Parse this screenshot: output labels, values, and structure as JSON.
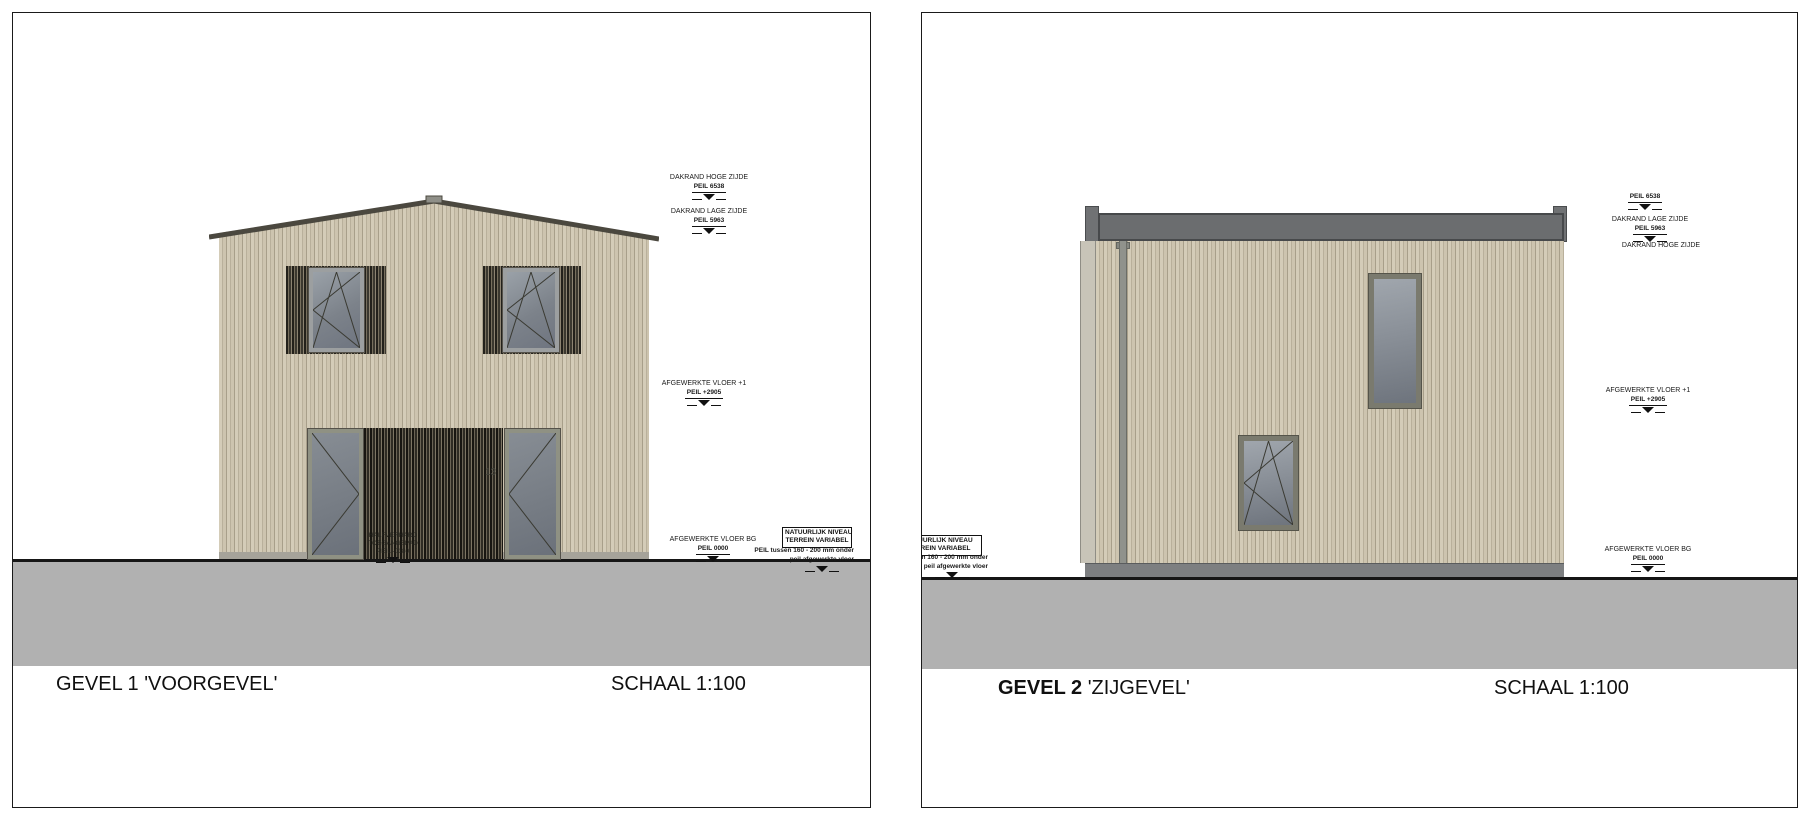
{
  "colors": {
    "facade_light": "#d4ccb8",
    "facade_stripe": "#a89f8a",
    "slats_dark": "#2e2b23",
    "window_frame": "#9c9fa0",
    "right_window_frame": "#7a7a6e",
    "glass": "#7c828a",
    "door_frame": "#8f9183",
    "roof_band": "#6b6d6f",
    "ground_band": "#b1b1b1",
    "line": "#161616"
  },
  "left_panel": {
    "title_prefix": "GEVEL 1",
    "title_name": "'VOORGEVEL'",
    "scale_label": "SCHAAL 1:100",
    "house_number": "13",
    "annotations": {
      "dakrand_hoge_label": "DAKRAND HOGE ZIJDE",
      "dakrand_hoge_peil": "PEIL 6538",
      "dakrand_lage_label": "DAKRAND LAGE ZIJDE",
      "dakrand_lage_peil": "PEIL 5963",
      "vloer1_label": "AFGEWERKTE VLOER +1",
      "vloer1_peil": "PEIL +2905",
      "vloerbg_label": "AFGEWERKTE VLOER BG",
      "vloerbg_peil": "PEIL 0000",
      "terrein_box_line1": "NATUURLIJK NIVEAU",
      "terrein_box_line2": "TERREIN VARIABEL",
      "terrein_note_line1": "PEIL tussen 160 - 200 mm onder",
      "terrein_note_line2": "peil afgewerkte vloer",
      "toegangspad_line1": "HALFVERHARD",
      "toegangspad_line2": "TOEGANGSPAD",
      "toegangspad_line3": "PEIL -0180"
    }
  },
  "right_panel": {
    "title_prefix": "GEVEL 2",
    "title_name": "'ZIJGEVEL'",
    "scale_label": "SCHAAL 1:100",
    "annotations": {
      "peil_top": "PEIL 6538",
      "dakrand_lage_label": "DAKRAND LAGE ZIJDE",
      "dakrand_lage_peil": "PEIL 5963",
      "dakrand_hoge_label": "DAKRAND HOGE ZIJDE",
      "vloer1_label": "AFGEWERKTE VLOER +1",
      "vloer1_peil": "PEIL +2905",
      "vloerbg_label": "AFGEWERKTE VLOER BG",
      "vloerbg_peil": "PEIL 0000",
      "terrein_box_line1": "NATUURLIJK NIVEAU",
      "terrein_box_line2": "TERREIN VARIABEL",
      "terrein_note_line1": "PEIL tussen 160 - 200 mm onder",
      "terrein_note_line2": "peil afgewerkte vloer"
    }
  }
}
